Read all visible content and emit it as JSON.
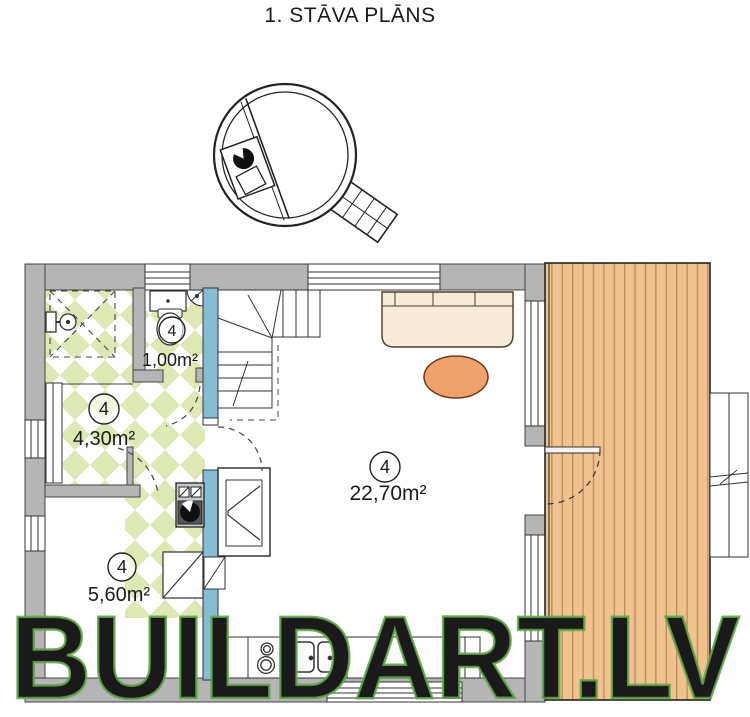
{
  "title": "1. STĀVA PLĀNS",
  "watermark": "BUILDART.LV",
  "plan": {
    "rooms": [
      {
        "number": "4",
        "area": "1,00m²"
      },
      {
        "number": "4",
        "area": "4,30m²"
      },
      {
        "number": "4",
        "area": "5,60m²"
      },
      {
        "number": "4",
        "area": "22,70m²"
      }
    ]
  },
  "colors": {
    "wall_gray": "#b5b5b5",
    "tile_green": "#dde8b5",
    "partition_blue": "#85bdd2",
    "deck_wood": "#f0c28e",
    "deck_line": "#b98b5e",
    "sofa_cream": "#f6ecd7",
    "rug_orange": "#f1a269",
    "watermark_green": "#5fa848",
    "line_dark": "#333333"
  }
}
